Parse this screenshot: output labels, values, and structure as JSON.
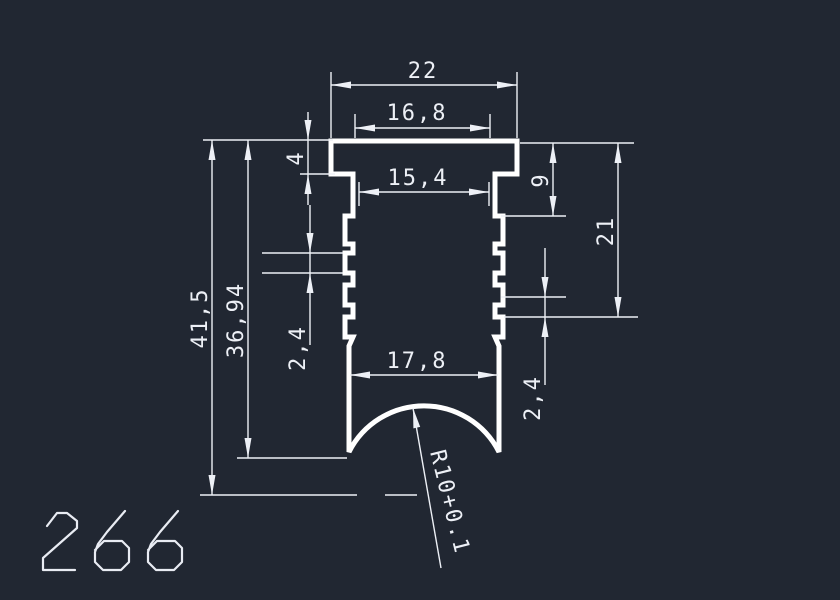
{
  "canvas": {
    "width": 840,
    "height": 600
  },
  "colors": {
    "background": "#212732",
    "lines": "#ffffff",
    "dim_lines": "#edf0f6"
  },
  "drawing": {
    "part_number": "266",
    "dimensions": {
      "overall_width": "22",
      "cap_width": "16,8",
      "neck_width": "15,4",
      "cap_height": "4",
      "overall_height": "41,5",
      "inner_height": "36,94",
      "left_tooth_pitch": "2,4",
      "shoulder_height": "9",
      "serration_zone_height": "21",
      "right_tooth_pitch": "2,4",
      "bottom_width": "17,8",
      "bottom_arc_radius": "R10+0.1"
    }
  }
}
